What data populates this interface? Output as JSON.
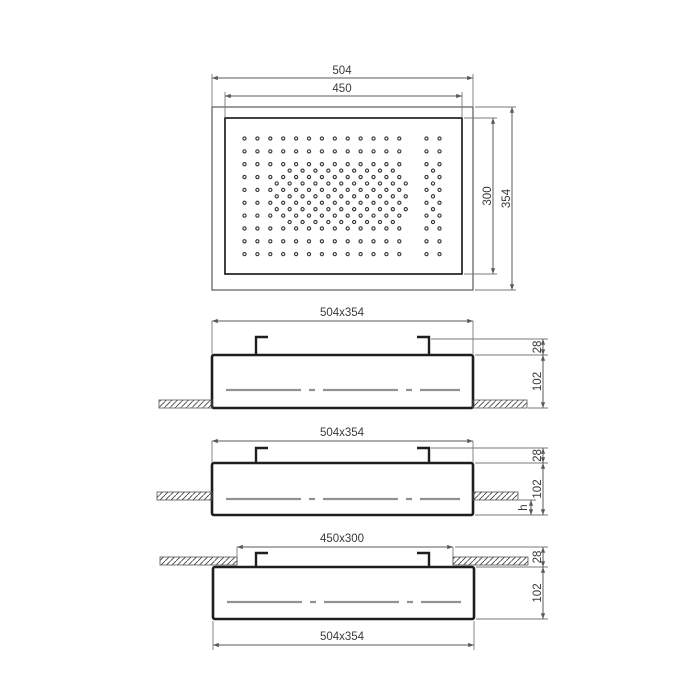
{
  "drawing": {
    "background": "#ffffff",
    "line_colors": {
      "outline": "#1e1e1e",
      "thin_outline": "#4a4a4a",
      "dimension": "#585858",
      "extension": "#7a7a7a",
      "centerline": "#929292",
      "hatch": "#3c3c3c",
      "text": "#3a3a3a",
      "nozzle": "#333333"
    },
    "top_view": {
      "name": "shower-head-top-view",
      "dims": {
        "outer_width": "504",
        "inner_width": "450",
        "inner_height": "300",
        "outer_height": "354"
      },
      "nozzles": {
        "grid_cols": 13,
        "grid_rows": 10,
        "right_pair_cols": 2,
        "offset_row_count": 5,
        "offset_rows_middle_dots": 11,
        "offset_rows_outer_dots": 9,
        "right_zigzag_dots": 5
      }
    },
    "section_views": [
      {
        "name": "recessed-installation",
        "dim_top": "504x354",
        "dim_bracket_height": "28",
        "dim_body_height": "102"
      },
      {
        "name": "semi-recessed-installation",
        "dim_top": "504x354",
        "dim_bracket_height": "28",
        "dim_body_height": "102",
        "dim_protrusion": "h"
      },
      {
        "name": "surface-installation",
        "dim_cutout": "450x300",
        "dim_bracket_height": "28",
        "dim_body_height": "102",
        "dim_bottom": "504x354"
      }
    ]
  }
}
